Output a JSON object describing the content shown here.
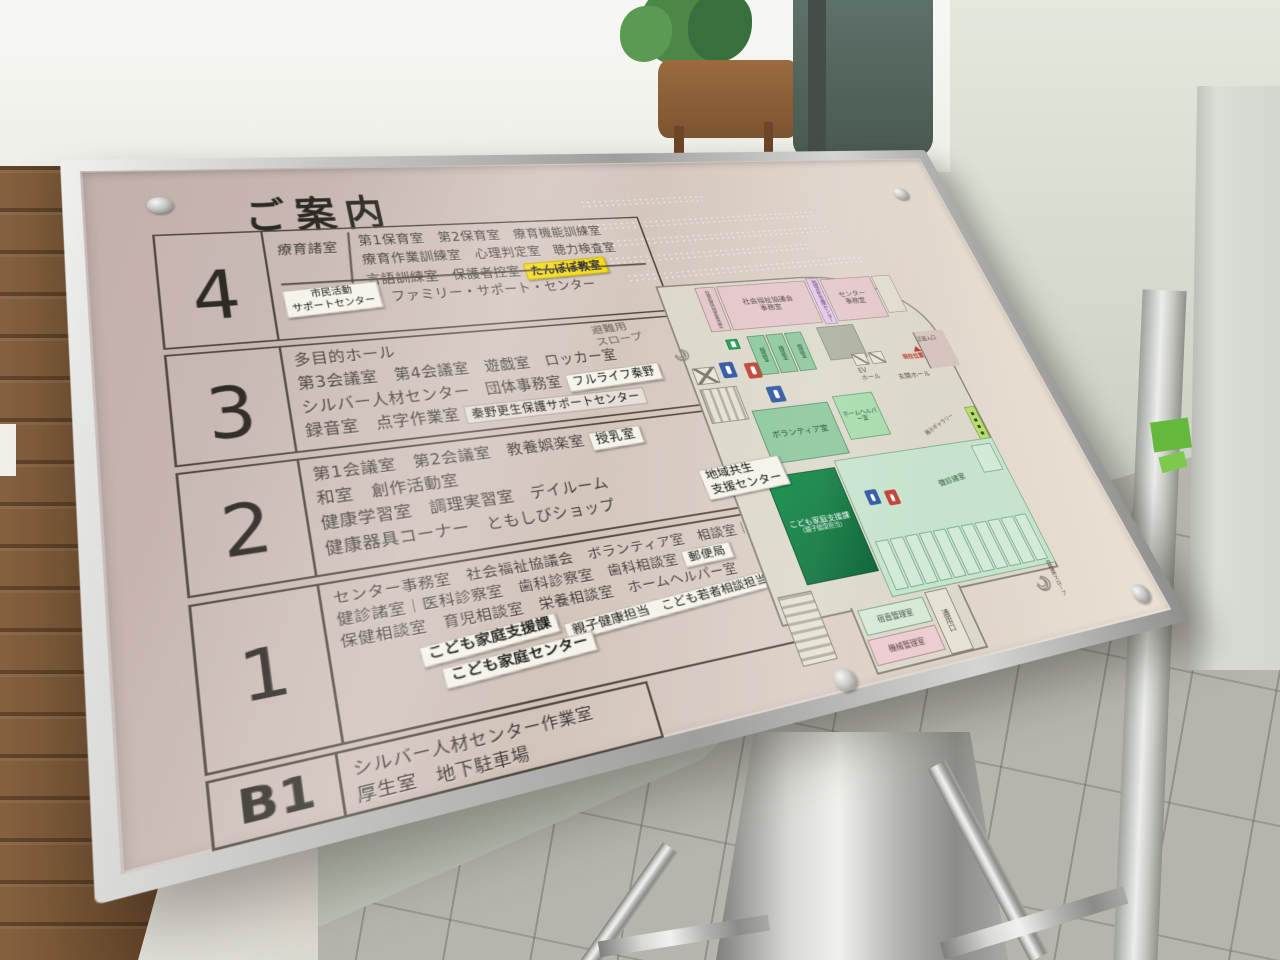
{
  "title": "ご案内",
  "floors": [
    {
      "number": "4",
      "category": "療育諸室",
      "line1": "第1保育室　第2保育室　療育機能訓練室",
      "line2": "療育作業訓練室　心理判定室　聴力検査室",
      "line3": "言語訓練室　保護者控室",
      "yellow_sticker": "たんぽぽ教室",
      "support_sticker": "市民活動\nサポートセンター",
      "bottom_line": "ファミリー・サポート・センター"
    },
    {
      "number": "3",
      "line1": "多目的ホール",
      "line2": "第3会議室　第4会議室　遊戯室　ロッカー室",
      "line3": "シルバー人材センター　団体事務室",
      "fulllife_sticker": "フルライフ秦野",
      "line4": "録音室　点字作業室",
      "hogo_sticker": "秦野更生保護サポートセンター"
    },
    {
      "number": "2",
      "line1": "第1会議室　第2会議室　教養娯楽室",
      "nursing_sticker": "授乳室",
      "line2": "和室　創作活動室",
      "line3": "健康学習室　調理実習室　デイルーム",
      "line4": "健康器具コーナー　ともしびショップ",
      "side_sticker": "地域共生\n支援センター"
    },
    {
      "number": "1",
      "line1": "センター事務室　社会福祉協議会　ボランティア室　相談室｜医師控室",
      "line2": "健診諸室｜医科診察室　歯科診察室　歯科相談室",
      "post_sticker": "郵便局",
      "faded_label": "老人クラブ",
      "line3": "保健相談室　育児相談室　栄養相談室　ホームヘルパー室",
      "kodomo_sticker1": "こども家庭支援課",
      "kodomo_sticker2": "親子健康担当　こども若者相談担当",
      "kodomo_sticker3": "こども家庭センター"
    },
    {
      "number": "B1",
      "line1": "シルバー人材センター作業室",
      "line2": "厚生室　地下駐車場"
    }
  ],
  "map": {
    "escape_slope_left": "避難用\nスロープ",
    "welfare_meeting_room": "社会福祉協議会会議室",
    "welfare_office": "社会福祉協議会\n事務室",
    "chiiki_sticker": "地域共生支援センター",
    "center_office": "センター\n事務室",
    "counsel_room": "相談室",
    "ev_hall": "EV\nホール",
    "entrance_hall": "玄関ホール",
    "you_are_here": "現在位置",
    "main_entrance": "正面入口",
    "courtyard": "光庭",
    "gallery": "展示ギャラリー",
    "volunteer_room": "ボランティア室",
    "home_helper_room": "ホームヘルパー室",
    "kodomo_division": "こども家庭支援課",
    "kodomo_division_sub": "（親子健康担当）",
    "kenshin_rooms": "健診諸室",
    "night_duty_office": "宿直管理室",
    "machine_room": "機械管理室",
    "service_entrance": "通用口",
    "escape_slope_right": "避難用スロープ"
  },
  "colors": {
    "sticker_yellow": "#f4d80a",
    "map_pink": "#e4c6ca",
    "map_green": "#8cc89d",
    "map_dark_green": "#0e8c46",
    "panel_pink": "#cdbcb4",
    "tape_green": "#64b83c"
  }
}
